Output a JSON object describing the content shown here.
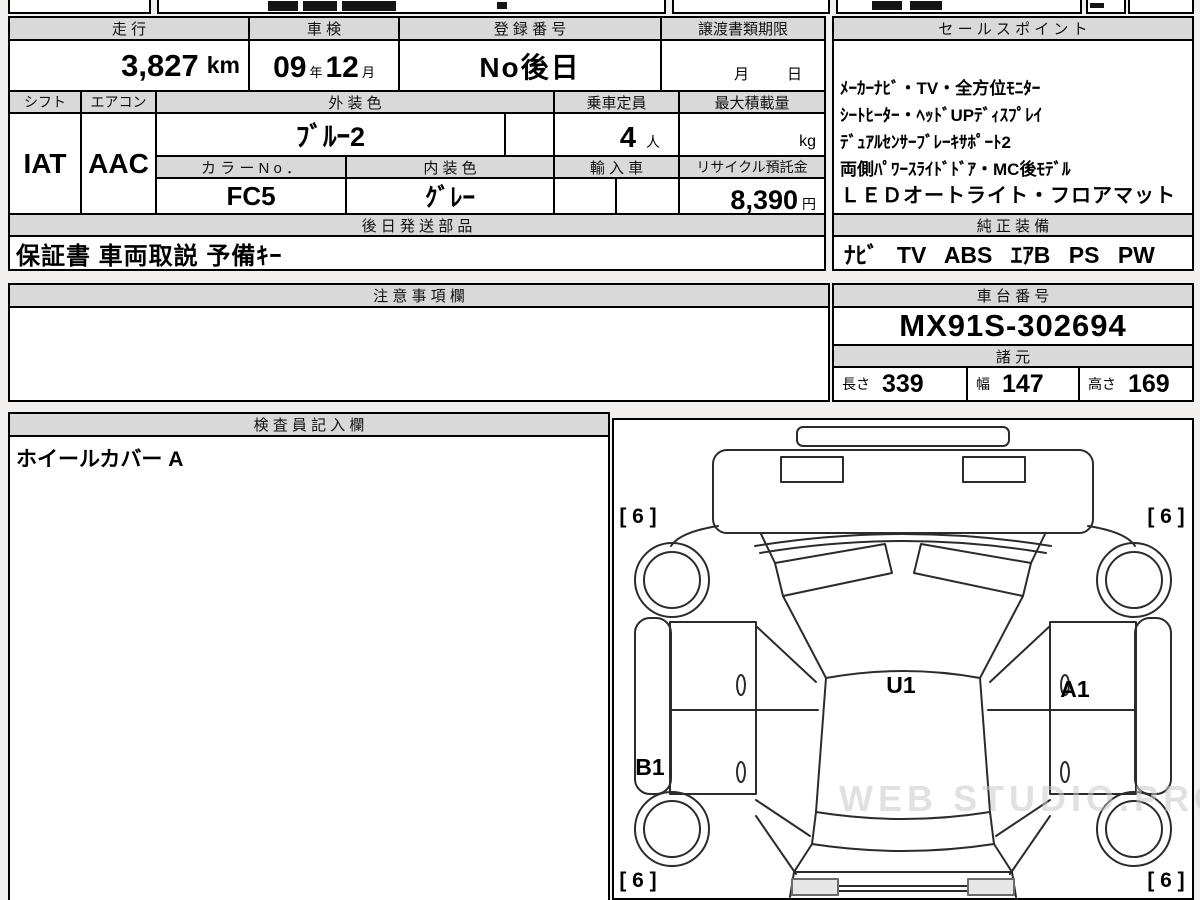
{
  "watermark": "WEB STUDIO.PRO",
  "table1": {
    "h_mileage": "走 行",
    "h_inspection": "車 検",
    "h_registration": "登 録 番 号",
    "h_transfer": "譲渡書類期限",
    "v_mileage": "3,827",
    "v_mileage_unit": "km",
    "v_insp_year": "09",
    "v_insp_year_suffix": "年",
    "v_insp_month": "12",
    "v_insp_month_suffix": "月",
    "v_registration": "No後日",
    "transfer_month": "月",
    "transfer_day": "日",
    "h_shift": "シフト",
    "h_aircon": "エアコン",
    "h_ext_color": "外 装 色",
    "h_capacity": "乗車定員",
    "h_max_load": "最大積載量",
    "v_shift": "IAT",
    "v_aircon": "AAC",
    "v_ext_color": "ﾌﾞﾙｰ2",
    "v_capacity": "4",
    "v_capacity_unit": "人",
    "v_max_load_unit": "kg",
    "h_color_no": "カ ラ ー N o ．",
    "h_int_color": "内 装 色",
    "h_import": "輸 入 車",
    "h_recycle": "リサイクル預託金",
    "v_color_no": "FC5",
    "v_int_color": "ｸﾞﾚｰ",
    "v_int_color_suffix": "系",
    "v_recycle": "8,390",
    "v_recycle_unit": "円",
    "h_later_parts": "後 日 発 送 部 品",
    "v_later_parts": "保証書 車両取説 予備ｷｰ"
  },
  "sales": {
    "header": "セ ー ル ス ポ イ ン ト",
    "lines": [
      "ﾒｰｶｰﾅﾋﾞ・TV・全方位ﾓﾆﾀｰ",
      "ｼｰﾄﾋｰﾀｰ・ﾍｯﾄﾞUPﾃﾞｨｽﾌﾟﾚｲ",
      "ﾃﾞｭｱﾙｾﾝｻｰﾌﾞﾚｰｷｻﾎﾟｰﾄ2",
      "両側ﾊﾟﾜｰｽﾗｲﾄﾞﾄﾞｱ・MC後ﾓﾃﾞﾙ",
      "ＬＥＤオートライト・フロアマット"
    ]
  },
  "equipment": {
    "header": "純 正 装 備",
    "value": "ﾅﾋﾞ TV ABS ｴｱB PS PW"
  },
  "notes": {
    "header": "注 意 事 項 欄",
    "value": ""
  },
  "chassis": {
    "header": "車 台 番 号",
    "value": "MX91S-302694"
  },
  "specs": {
    "header": "諸 元",
    "length_label": "長さ",
    "length_value": "339",
    "width_label": "幅",
    "width_value": "147",
    "height_label": "高さ",
    "height_value": "169"
  },
  "inspector": {
    "header": "検 査 員 記 入 欄",
    "value": "ホイールカバー A"
  },
  "diagram": {
    "roof_label": "U1",
    "right_door_label": "A1",
    "left_sill_label": "B1",
    "corner_tl": "[ 6 ]",
    "corner_tr": "[ 6 ]",
    "corner_bl": "[ 6 ]",
    "corner_br": "[ 6 ]"
  }
}
